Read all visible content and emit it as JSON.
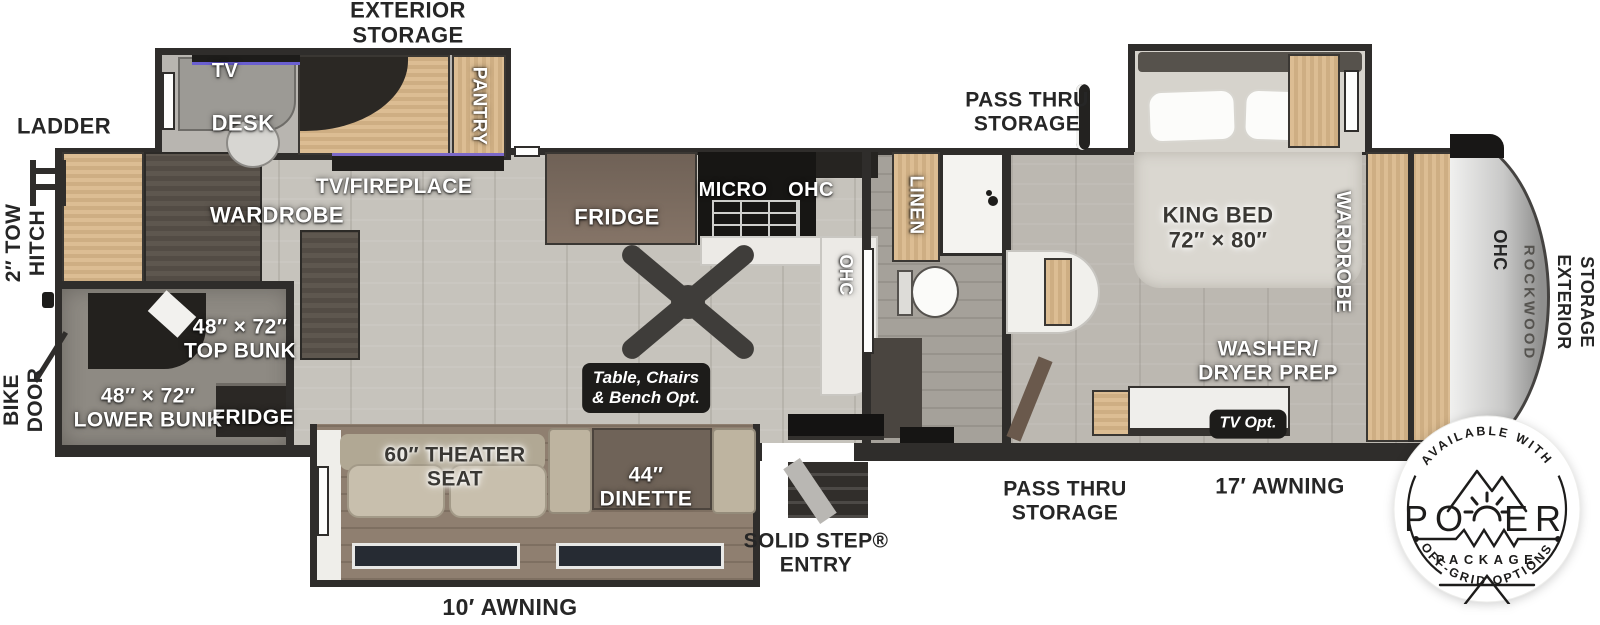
{
  "colors": {
    "wall": "#2f2d2b",
    "floor": "#c6c3bc",
    "wood_light": "#d4b58c",
    "wood_dark": "#575049",
    "fireplace_glow": "#7b68c8",
    "label_white": "#ffffff",
    "label_dark": "#3a3834",
    "badge_ink": "#1d1c1b"
  },
  "outside": {
    "exterior_storage_top": "EXTERIOR\nSTORAGE",
    "ladder": "LADDER",
    "tow_hitch_line1": "2″ TOW",
    "tow_hitch_line2": "HITCH",
    "bike_door_line1": "BIKE",
    "bike_door_line2": "DOOR",
    "awning_rear": "10′ AWNING",
    "solid_step_entry": "SOLID STEP®\nENTRY",
    "pass_thru_storage_bottom": "PASS THRU\nSTORAGE",
    "awning_front": "17′ AWNING",
    "pass_thru_storage_top": "PASS THRU\nSTORAGE",
    "exterior_storage_front_line1": "EXTERIOR",
    "exterior_storage_front_line2": "STORAGE"
  },
  "interior": {
    "tv": "TV",
    "desk": "DESK",
    "pantry": "PANTRY",
    "wardrobe_rear": "WARDROBE",
    "tv_fireplace": "TV/FIREPLACE",
    "top_bunk": "48″ × 72″\nTOP BUNK",
    "lower_bunk": "48″ × 72″\nLOWER BUNK",
    "bunk_fridge": "FRIDGE",
    "kitchen_fridge": "FRIDGE",
    "micro": "MICRO",
    "ohc_kitchen": "OHC",
    "ohc_counter": "OHC",
    "theater_seat": "60″ THEATER\nSEAT",
    "dinette": "44″\nDINETTE",
    "table_option": "Table, Chairs\n& Bench Opt.",
    "linen": "LINEN",
    "king_bed": "KING BED\n72″ × 80″",
    "wardrobe_bedroom": "WARDROBE",
    "washer_dryer": "WASHER/\nDRYER PREP",
    "tv_option": "TV Opt.",
    "ohc_front": "OHC",
    "brand": "ROCKWOOD"
  },
  "badge": {
    "arc_top": "AVAILABLE WITH",
    "power_left": "PO",
    "power_right": "ER",
    "package": "PACKAGE",
    "arc_bottom": "OFF-GRID OPTIONS"
  }
}
